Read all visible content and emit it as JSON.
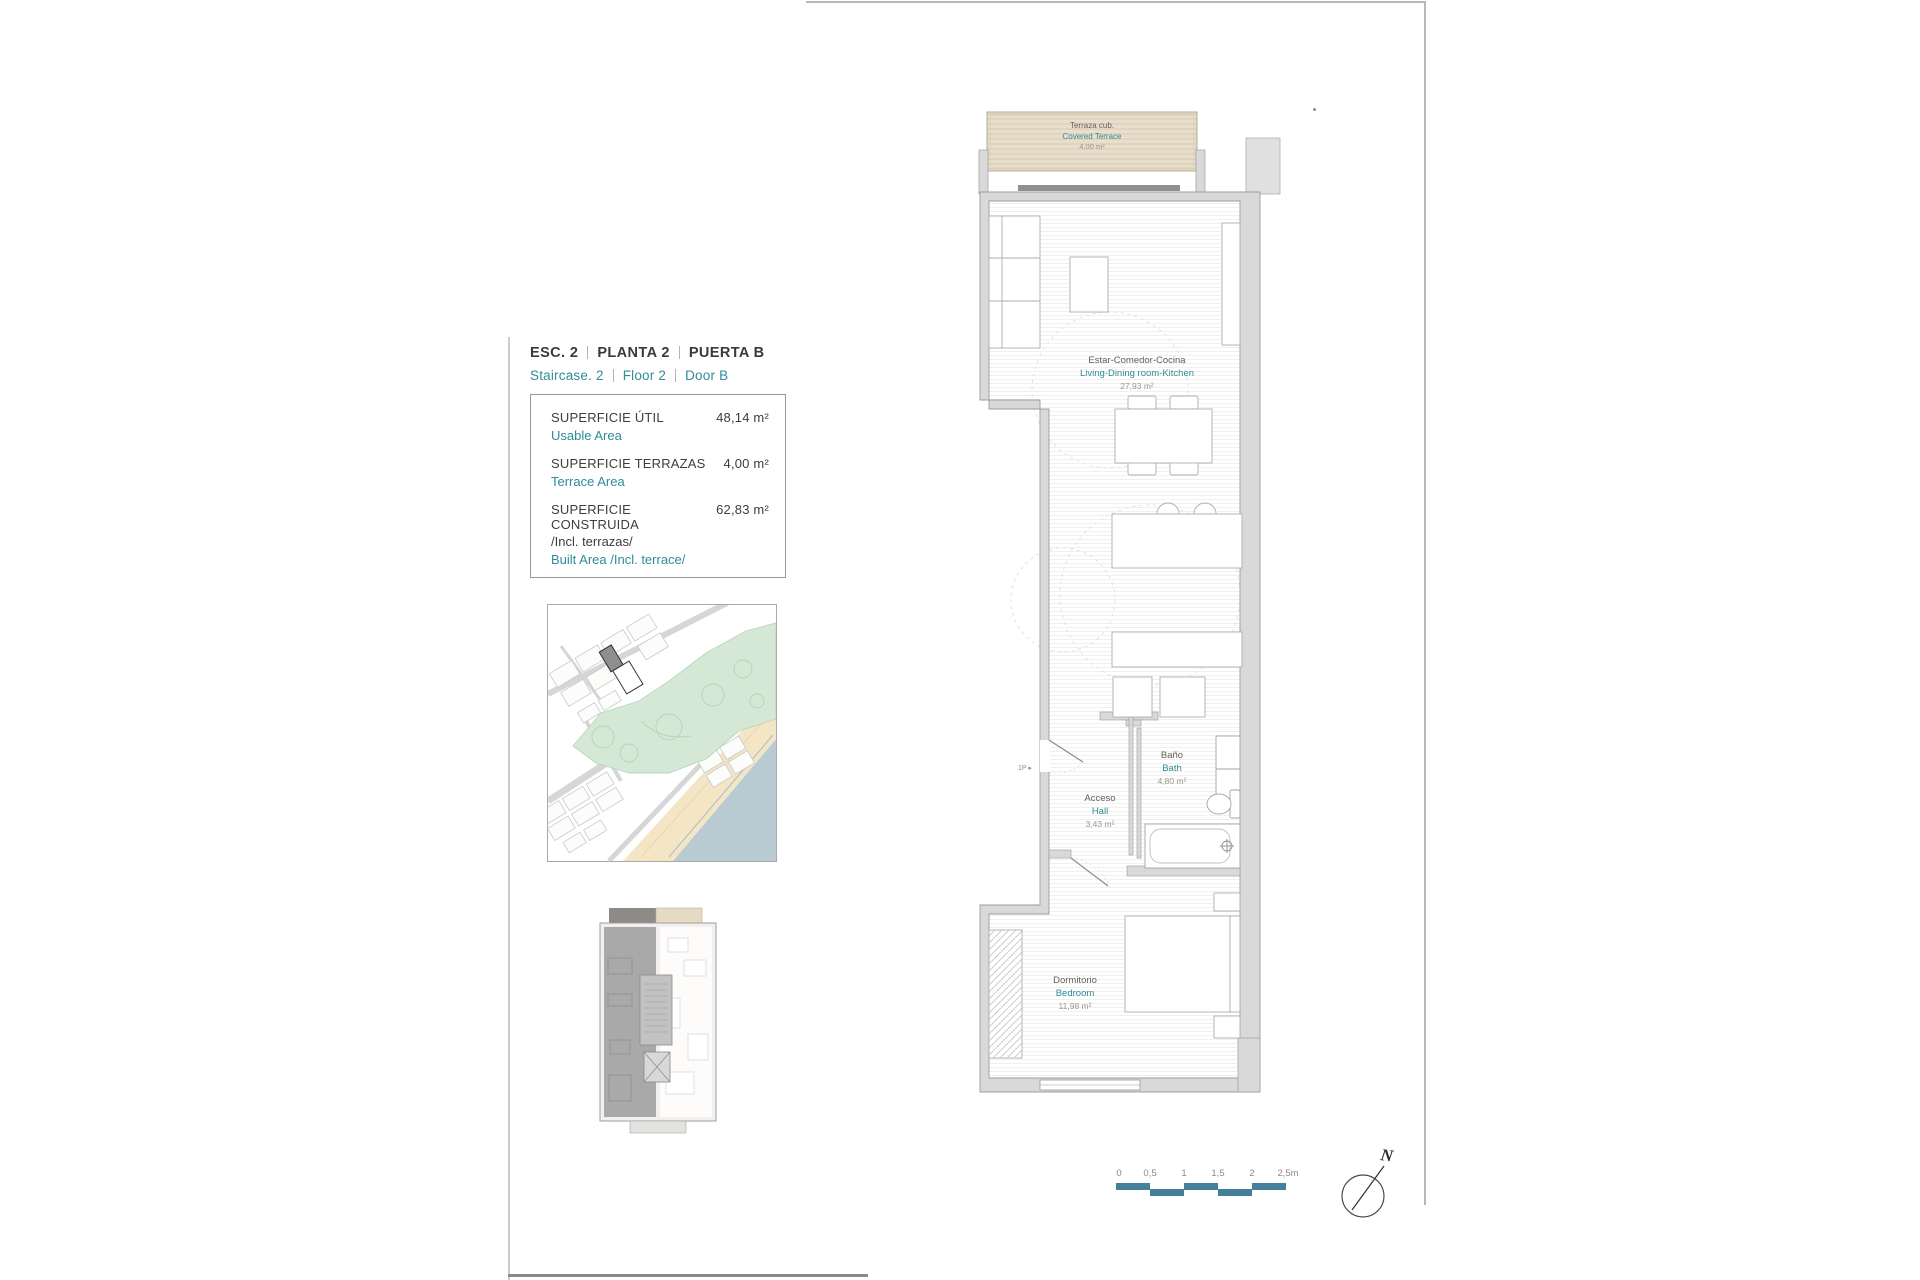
{
  "header": {
    "esc_label": "ESC. 2",
    "planta_label": "PLANTA 2",
    "puerta_label": "PUERTA B",
    "staircase_label": "Staircase. 2",
    "floor_label": "Floor 2",
    "door_label": "Door B"
  },
  "area_table": {
    "rows": [
      {
        "label_es": "SUPERFICIE ÚTIL",
        "label_en": "Usable Area",
        "value": "48,14 m²"
      },
      {
        "label_es": "SUPERFICIE TERRAZAS",
        "label_en": "Terrace Area",
        "value": "4,00 m²"
      },
      {
        "label_es": "SUPERFICIE CONSTRUIDA",
        "label_es2": "/Incl. terrazas/",
        "label_en": "Built Area /Incl. terrace/",
        "value": "62,83 m²"
      }
    ]
  },
  "floor_plan": {
    "rooms": {
      "terrace": {
        "name_es": "Terraza cub.",
        "name_en": "Covered Terrace",
        "area": "4,00 m²"
      },
      "living": {
        "name_es": "Estar-Comedor-Cocina",
        "name_en": "Living-Dining room-Kitchen",
        "area": "27,93 m²"
      },
      "bath": {
        "name_es": "Baño",
        "name_en": "Bath",
        "area": "4,80 m²"
      },
      "hall": {
        "name_es": "Acceso",
        "name_en": "Hall",
        "area": "3,43 m²"
      },
      "bedroom": {
        "name_es": "Dormitorio",
        "name_en": "Bedroom",
        "area": "11,98 m²"
      }
    },
    "entrance_marker": "1P ▸"
  },
  "scale_bar": {
    "ticks": [
      "0",
      "0,5",
      "1",
      "1,5",
      "2",
      "2,5m"
    ]
  },
  "compass": {
    "label": "N"
  },
  "colors": {
    "accent_teal": "#2F8C99",
    "scalebar_teal": "#45809B",
    "terrace_tan": "#E8DECB",
    "wall_gray": "#D9D9D9",
    "map_green": "#D4E8D5",
    "beach_sand": "#F4E6C5",
    "sea_blue": "#B9CBD2",
    "highlight_building_gray": "#8F8F8F"
  }
}
